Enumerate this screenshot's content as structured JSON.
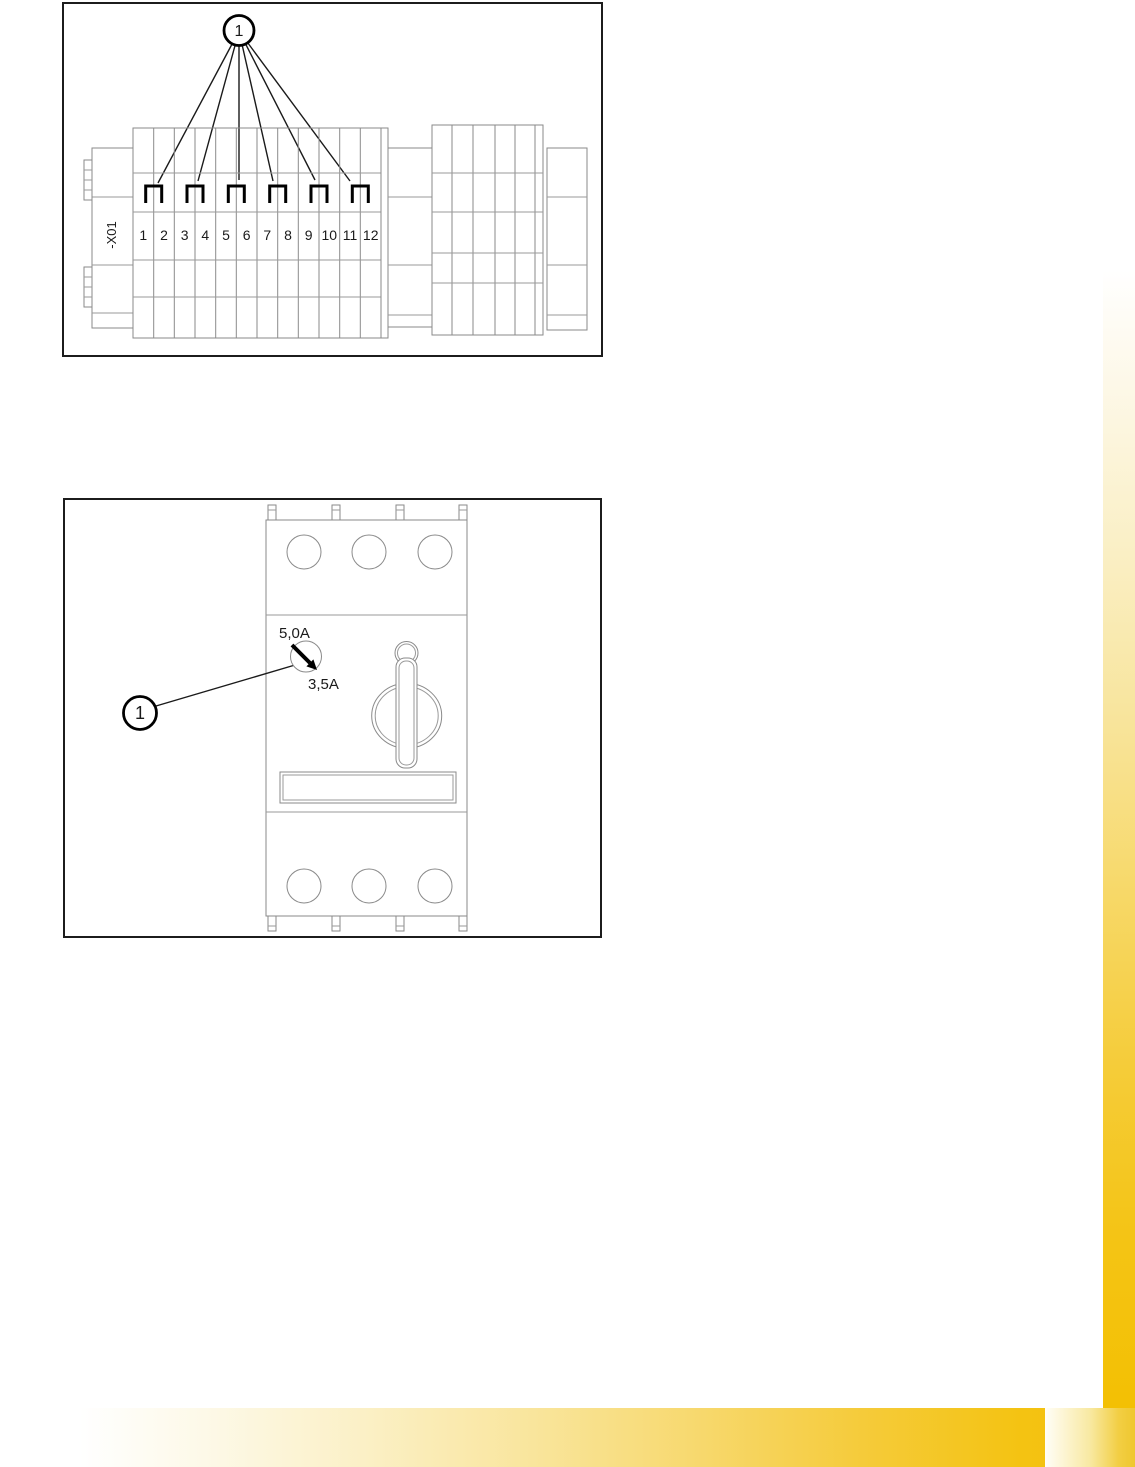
{
  "page": {
    "background": "#ffffff",
    "accent_gold": "#f3c003"
  },
  "figure1": {
    "title": "terminal-block-diagram",
    "callout": {
      "label": "1"
    },
    "terminal_tag": "-X01",
    "terminals": [
      "1",
      "2",
      "3",
      "4",
      "5",
      "6",
      "7",
      "8",
      "9",
      "10",
      "11",
      "12"
    ],
    "jumper_pairs": [
      "1-2",
      "3-4",
      "5-6",
      "7-8",
      "9-10",
      "11-12"
    ]
  },
  "figure2": {
    "title": "motor-circuit-breaker-diagram",
    "callout": {
      "label": "1"
    },
    "dial": {
      "max_label": "5,0A",
      "set_label": "3,5A"
    }
  }
}
